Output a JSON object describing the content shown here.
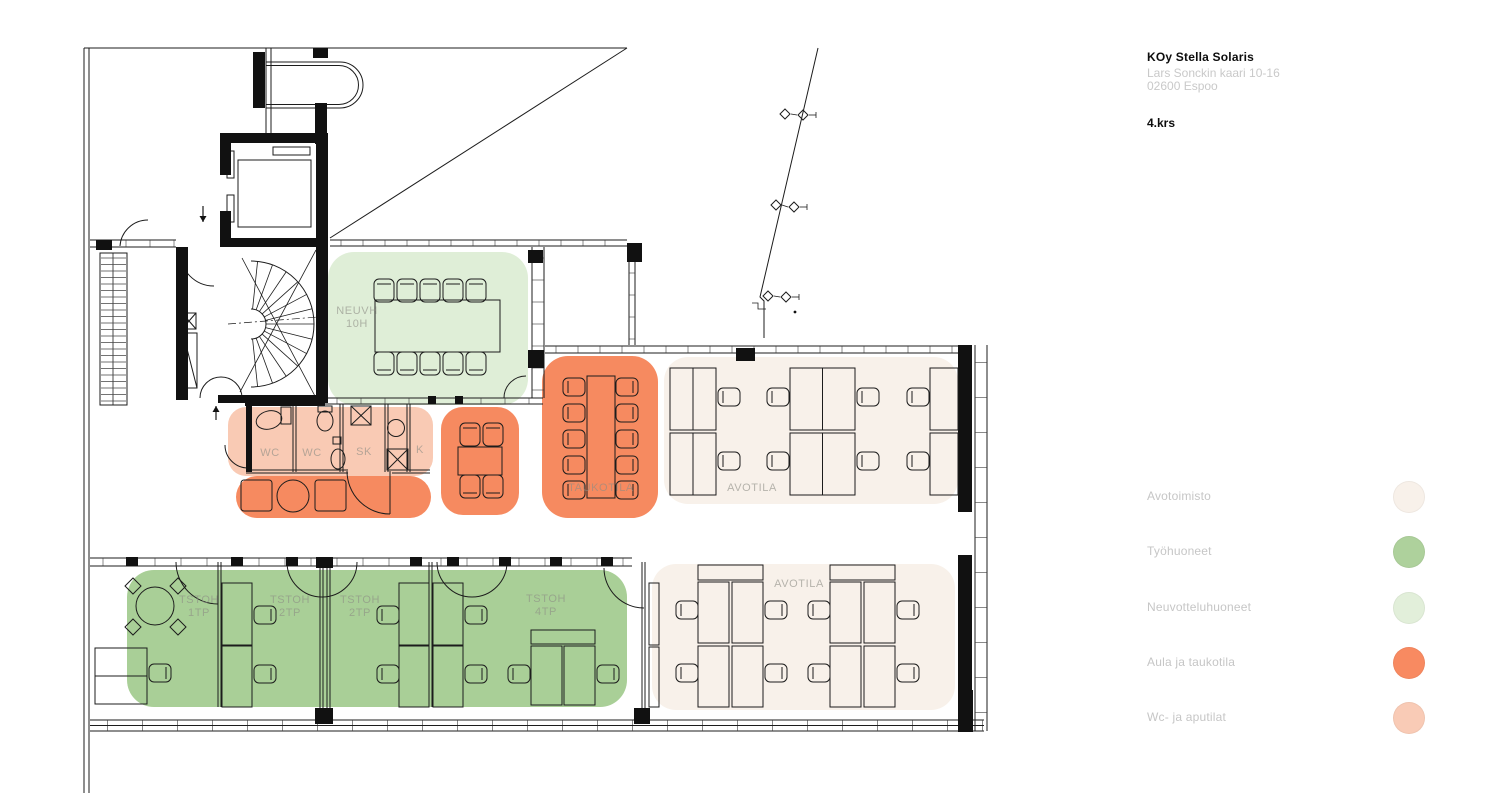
{
  "title_block": {
    "building": "KOy Stella Solaris",
    "address_line1": "Lars Sonckin kaari 10-16",
    "address_line2": "02600 Espoo",
    "floor_label": "4.krs"
  },
  "legend": {
    "items": [
      {
        "id": "avotoimisto",
        "label": "Avotoimisto",
        "color": "#f8f1ea"
      },
      {
        "id": "tyohuoneet",
        "label": "Työhuoneet",
        "color": "#aed19c"
      },
      {
        "id": "neuvotteluhuoneet",
        "label": "Neuvotteluhuoneet",
        "color": "#e2efda"
      },
      {
        "id": "aula_taukotila",
        "label": "Aula ja taukotila",
        "color": "#f88a61"
      },
      {
        "id": "wc_aputilat",
        "label": "Wc- ja aputilat",
        "color": "#f9cbb6"
      }
    ]
  },
  "plan": {
    "zone_colors": {
      "avotoimisto": "#f8f1ea",
      "tyohuoneet": "#a9cf97",
      "neuvotteluhuoneet": "#dfeed7",
      "aula_taukotila": "#f68a60",
      "wc_aputilat": "#f9cab4"
    },
    "rooms": {
      "neuvh": {
        "line1": "NEUVH",
        "line2": "10H"
      },
      "taukotila": {
        "line1": "TAUKOTILA"
      },
      "avotila_top": {
        "line1": "AVOTILA"
      },
      "avotila_bottom": {
        "line1": "AVOTILA"
      },
      "tstoh_1tp": {
        "line1": "TSTOH",
        "line2": "1TP"
      },
      "tstoh_2tp_a": {
        "line1": "TSTOH",
        "line2": "2TP"
      },
      "tstoh_2tp_b": {
        "line1": "TSTOH",
        "line2": "2TP"
      },
      "tstoh_4tp": {
        "line1": "TSTOH",
        "line2": "4TP"
      },
      "wc_a": {
        "line1": "WC"
      },
      "wc_b": {
        "line1": "WC"
      },
      "sk": {
        "line1": "SK"
      },
      "k": {
        "line1": "K"
      }
    }
  }
}
